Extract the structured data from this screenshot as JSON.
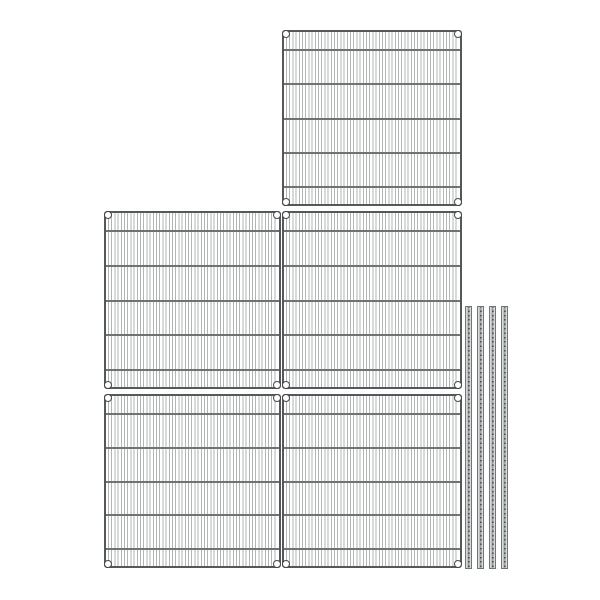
{
  "meta": {
    "description": "Product image of a wire shelving kit: five chrome wire shelf panels shown top-down and four grooved shelving posts on a plain white background",
    "canvas": {
      "width": 600,
      "height": 600,
      "background": "#ffffff"
    }
  },
  "palette": {
    "frame": "#54585a",
    "crossbar": "#6d7274",
    "wire": "#b1b5b5",
    "ring_stroke": "#45494b",
    "ring_fill": "#ffffff",
    "post_edge": "#717576",
    "post_body": "#d9dbdb",
    "post_groove": "#9aa0a1",
    "post_dash": "#51585a"
  },
  "shelf_pattern": {
    "wire_pitch_px": 3.2,
    "corner_ring_diameter_px": 8,
    "crossbar_positions_pct": [
      10.3,
      30.5,
      50.3,
      70.2,
      90
    ],
    "corner_rings_per_shelf": 4
  },
  "shelves": [
    {
      "id": "wire-shelf-top",
      "left": 282,
      "top": 30,
      "width": 180,
      "height": 176
    },
    {
      "id": "wire-shelf-middle-left",
      "left": 104,
      "top": 211,
      "width": 177,
      "height": 178
    },
    {
      "id": "wire-shelf-middle-right",
      "left": 282,
      "top": 211,
      "width": 180,
      "height": 178
    },
    {
      "id": "wire-shelf-bottom-left",
      "left": 104,
      "top": 394,
      "width": 177,
      "height": 174
    },
    {
      "id": "wire-shelf-bottom-right",
      "left": 282,
      "top": 394,
      "width": 180,
      "height": 174
    }
  ],
  "posts": [
    {
      "id": "shelf-post-1",
      "left": 465,
      "top": 306,
      "width": 7,
      "height": 263
    },
    {
      "id": "shelf-post-2",
      "left": 477,
      "top": 306,
      "width": 7,
      "height": 263
    },
    {
      "id": "shelf-post-3",
      "left": 489,
      "top": 306,
      "width": 7,
      "height": 263
    },
    {
      "id": "shelf-post-4",
      "left": 501,
      "top": 306,
      "width": 7,
      "height": 263
    }
  ],
  "counts": {
    "shelves": 5,
    "posts": 4
  }
}
